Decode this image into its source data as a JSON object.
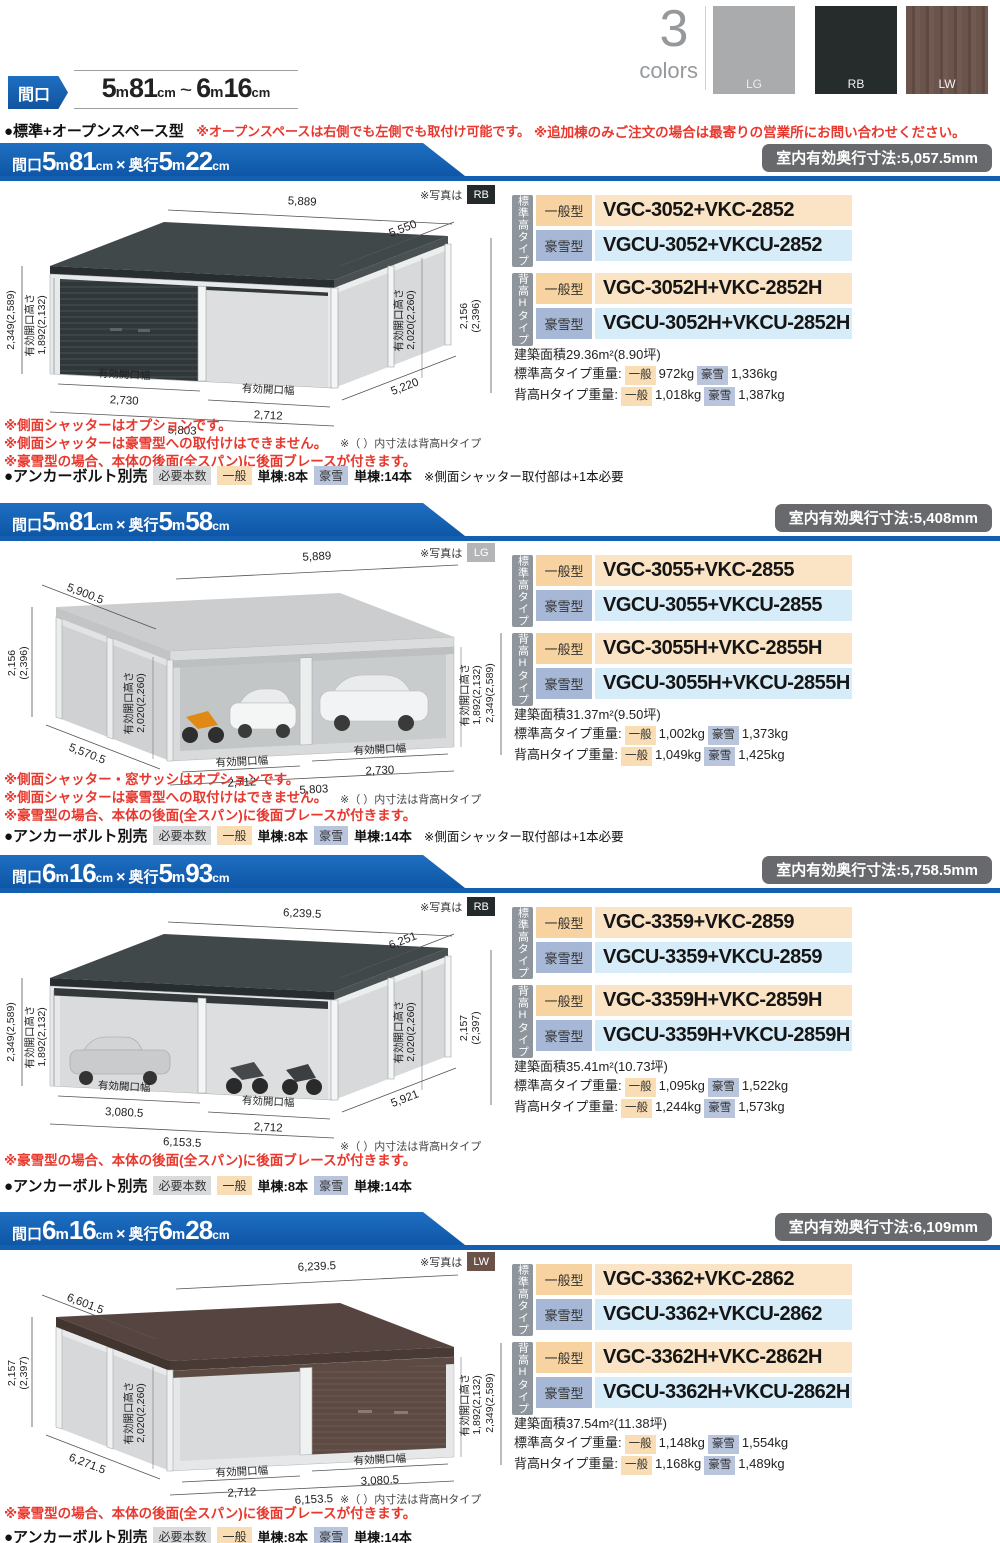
{
  "top": {
    "chip": "間口",
    "range_a": "5",
    "range_m1": "m",
    "range_b": "81",
    "range_c1": "cm",
    "tilde": "~",
    "range_d": "6",
    "range_m2": "m",
    "range_e": "16",
    "range_c2": "cm",
    "type_label": "●標準+オープンスペース型",
    "type_note": "※オープンスペースは右側でも左側でも取付け可能です。",
    "order_note": "※追加棟のみご注文の場合は最寄りの営業所にお問い合わせください。",
    "colors_count": "3",
    "colors_word": "colors",
    "swatches": [
      {
        "code": "LG",
        "hex": "#a9abad"
      },
      {
        "code": "RB",
        "hex": "#262c2b"
      },
      {
        "code": "LW",
        "hex": "#6a544c"
      }
    ],
    "accent_blue": "#1360b2",
    "red": "#e8382e"
  },
  "common": {
    "photo_prefix": "※写真は",
    "open_h": "有効開口高さ",
    "open_w": "有効開口幅",
    "group1": "標準高タイプ",
    "group2": "背高Hタイプ",
    "type_general": "一般型",
    "type_snow": "豪雪型",
    "tag_general": "一般",
    "tag_snow": "豪雪",
    "paren_note": "※（ ）内寸法は背高Hタイプ",
    "anchor_label": "●アンカーボルト別売",
    "anchor_tag": "必要本数",
    "anchor_general": "単棟:8本",
    "anchor_snow": "単棟:14本",
    "anchor_extra": "※側面シャッター取付部は+1本必要",
    "weight1_label": "標準高タイプ重量:",
    "weight2_label": "背高Hタイプ重量:"
  },
  "sections": [
    {
      "title": {
        "l1": "間口",
        "a": "5",
        "m1": "m",
        "b": "81",
        "u1": "cm",
        "x": "×",
        "l2": "奥行",
        "c": "5",
        "m2": "m",
        "d": "22",
        "u2": "cm"
      },
      "badge": "室内有効奥行寸法:5,057.5mm",
      "photo_color": "RB",
      "dims": {
        "top_w": "5,889",
        "top_d": "5,550",
        "left_outer": "2,349(2,589)",
        "left_open": "1,892(2,132)",
        "inner_open": "2,020(2,260)",
        "right_l1": "2,156",
        "right_l2": "(2,396)",
        "w1": "2,730",
        "w2": "2,712",
        "total": "5,803",
        "diag": "5,220"
      },
      "models": [
        {
          "type": "一般型",
          "code": "VGC-3052+VKC-2852"
        },
        {
          "type": "豪雪型",
          "code": "VGCU-3052+VKCU-2852"
        },
        {
          "type": "一般型",
          "code": "VGC-3052H+VKC-2852H"
        },
        {
          "type": "豪雪型",
          "code": "VGCU-3052H+VKCU-2852H"
        }
      ],
      "area": "建築面積29.36m²(8.90坪)",
      "w1_gen": "972kg",
      "w1_snow": "1,336kg",
      "w2_gen": "1,018kg",
      "w2_snow": "1,387kg",
      "notes": [
        "※側面シャッターはオプションです。",
        "※側面シャッターは豪雪型への取付けはできません。",
        "※豪雪型の場合、本体の後面(全スパン)に後面ブレースが付きます。"
      ]
    },
    {
      "title": {
        "l1": "間口",
        "a": "5",
        "m1": "m",
        "b": "81",
        "u1": "cm",
        "x": "×",
        "l2": "奥行",
        "c": "5",
        "m2": "m",
        "d": "58",
        "u2": "cm"
      },
      "badge": "室内有効奥行寸法:5,408mm",
      "photo_color": "LG",
      "dims": {
        "top_d": "5,900.5",
        "top_w": "5,889",
        "left_l1": "2,156",
        "left_l2": "(2,396)",
        "inner_open": "2,020(2,260)",
        "right_open": "1,892(2,132)",
        "right_outer": "2,349(2,589)",
        "diag": "5,570.5",
        "w1": "2,712",
        "w2": "2,730",
        "total": "5,803"
      },
      "models": [
        {
          "type": "一般型",
          "code": "VGC-3055+VKC-2855"
        },
        {
          "type": "豪雪型",
          "code": "VGCU-3055+VKCU-2855"
        },
        {
          "type": "一般型",
          "code": "VGC-3055H+VKC-2855H"
        },
        {
          "type": "豪雪型",
          "code": "VGCU-3055H+VKCU-2855H"
        }
      ],
      "area": "建築面積31.37m²(9.50坪)",
      "w1_gen": "1,002kg",
      "w1_snow": "1,373kg",
      "w2_gen": "1,049kg",
      "w2_snow": "1,425kg",
      "notes": [
        "※側面シャッター・窓サッシはオプションです。",
        "※側面シャッターは豪雪型への取付けはできません。",
        "※豪雪型の場合、本体の後面(全スパン)に後面ブレースが付きます。"
      ]
    },
    {
      "title": {
        "l1": "間口",
        "a": "6",
        "m1": "m",
        "b": "16",
        "u1": "cm",
        "x": "×",
        "l2": "奥行",
        "c": "5",
        "m2": "m",
        "d": "93",
        "u2": "cm"
      },
      "badge": "室内有効奥行寸法:5,758.5mm",
      "photo_color": "RB",
      "dims": {
        "top_w": "6,239.5",
        "top_d": "6,251",
        "left_outer": "2,349(2,589)",
        "left_open": "1,892(2,132)",
        "inner_open": "2,020(2,260)",
        "right_l1": "2,157",
        "right_l2": "(2,397)",
        "w1": "3,080.5",
        "w2": "2,712",
        "total": "6,153.5",
        "diag": "5,921"
      },
      "models": [
        {
          "type": "一般型",
          "code": "VGC-3359+VKC-2859"
        },
        {
          "type": "豪雪型",
          "code": "VGCU-3359+VKCU-2859"
        },
        {
          "type": "一般型",
          "code": "VGC-3359H+VKC-2859H"
        },
        {
          "type": "豪雪型",
          "code": "VGCU-3359H+VKCU-2859H"
        }
      ],
      "area": "建築面積35.41m²(10.73坪)",
      "w1_gen": "1,095kg",
      "w1_snow": "1,522kg",
      "w2_gen": "1,244kg",
      "w2_snow": "1,573kg",
      "notes": [
        "※豪雪型の場合、本体の後面(全スパン)に後面ブレースが付きます。"
      ]
    },
    {
      "title": {
        "l1": "間口",
        "a": "6",
        "m1": "m",
        "b": "16",
        "u1": "cm",
        "x": "×",
        "l2": "奥行",
        "c": "6",
        "m2": "m",
        "d": "28",
        "u2": "cm"
      },
      "badge": "室内有効奥行寸法:6,109mm",
      "photo_color": "LW",
      "dims": {
        "top_d": "6,601.5",
        "top_w": "6,239.5",
        "left_l1": "2,157",
        "left_l2": "(2,397)",
        "inner_open": "2,020(2,260)",
        "right_open": "1,892(2,132)",
        "right_outer": "2,349(2,589)",
        "diag": "6,271.5",
        "w1": "2,712",
        "w2": "3,080.5",
        "total": "6,153.5"
      },
      "models": [
        {
          "type": "一般型",
          "code": "VGC-3362+VKC-2862"
        },
        {
          "type": "豪雪型",
          "code": "VGCU-3362+VKCU-2862"
        },
        {
          "type": "一般型",
          "code": "VGC-3362H+VKC-2862H"
        },
        {
          "type": "豪雪型",
          "code": "VGCU-3362H+VKCU-2862H"
        }
      ],
      "area": "建築面積37.54m²(11.38坪)",
      "w1_gen": "1,148kg",
      "w1_snow": "1,554kg",
      "w2_gen": "1,168kg",
      "w2_snow": "1,489kg",
      "notes": [
        "※豪雪型の場合、本体の後面(全スパン)に後面ブレースが付きます。"
      ]
    }
  ]
}
